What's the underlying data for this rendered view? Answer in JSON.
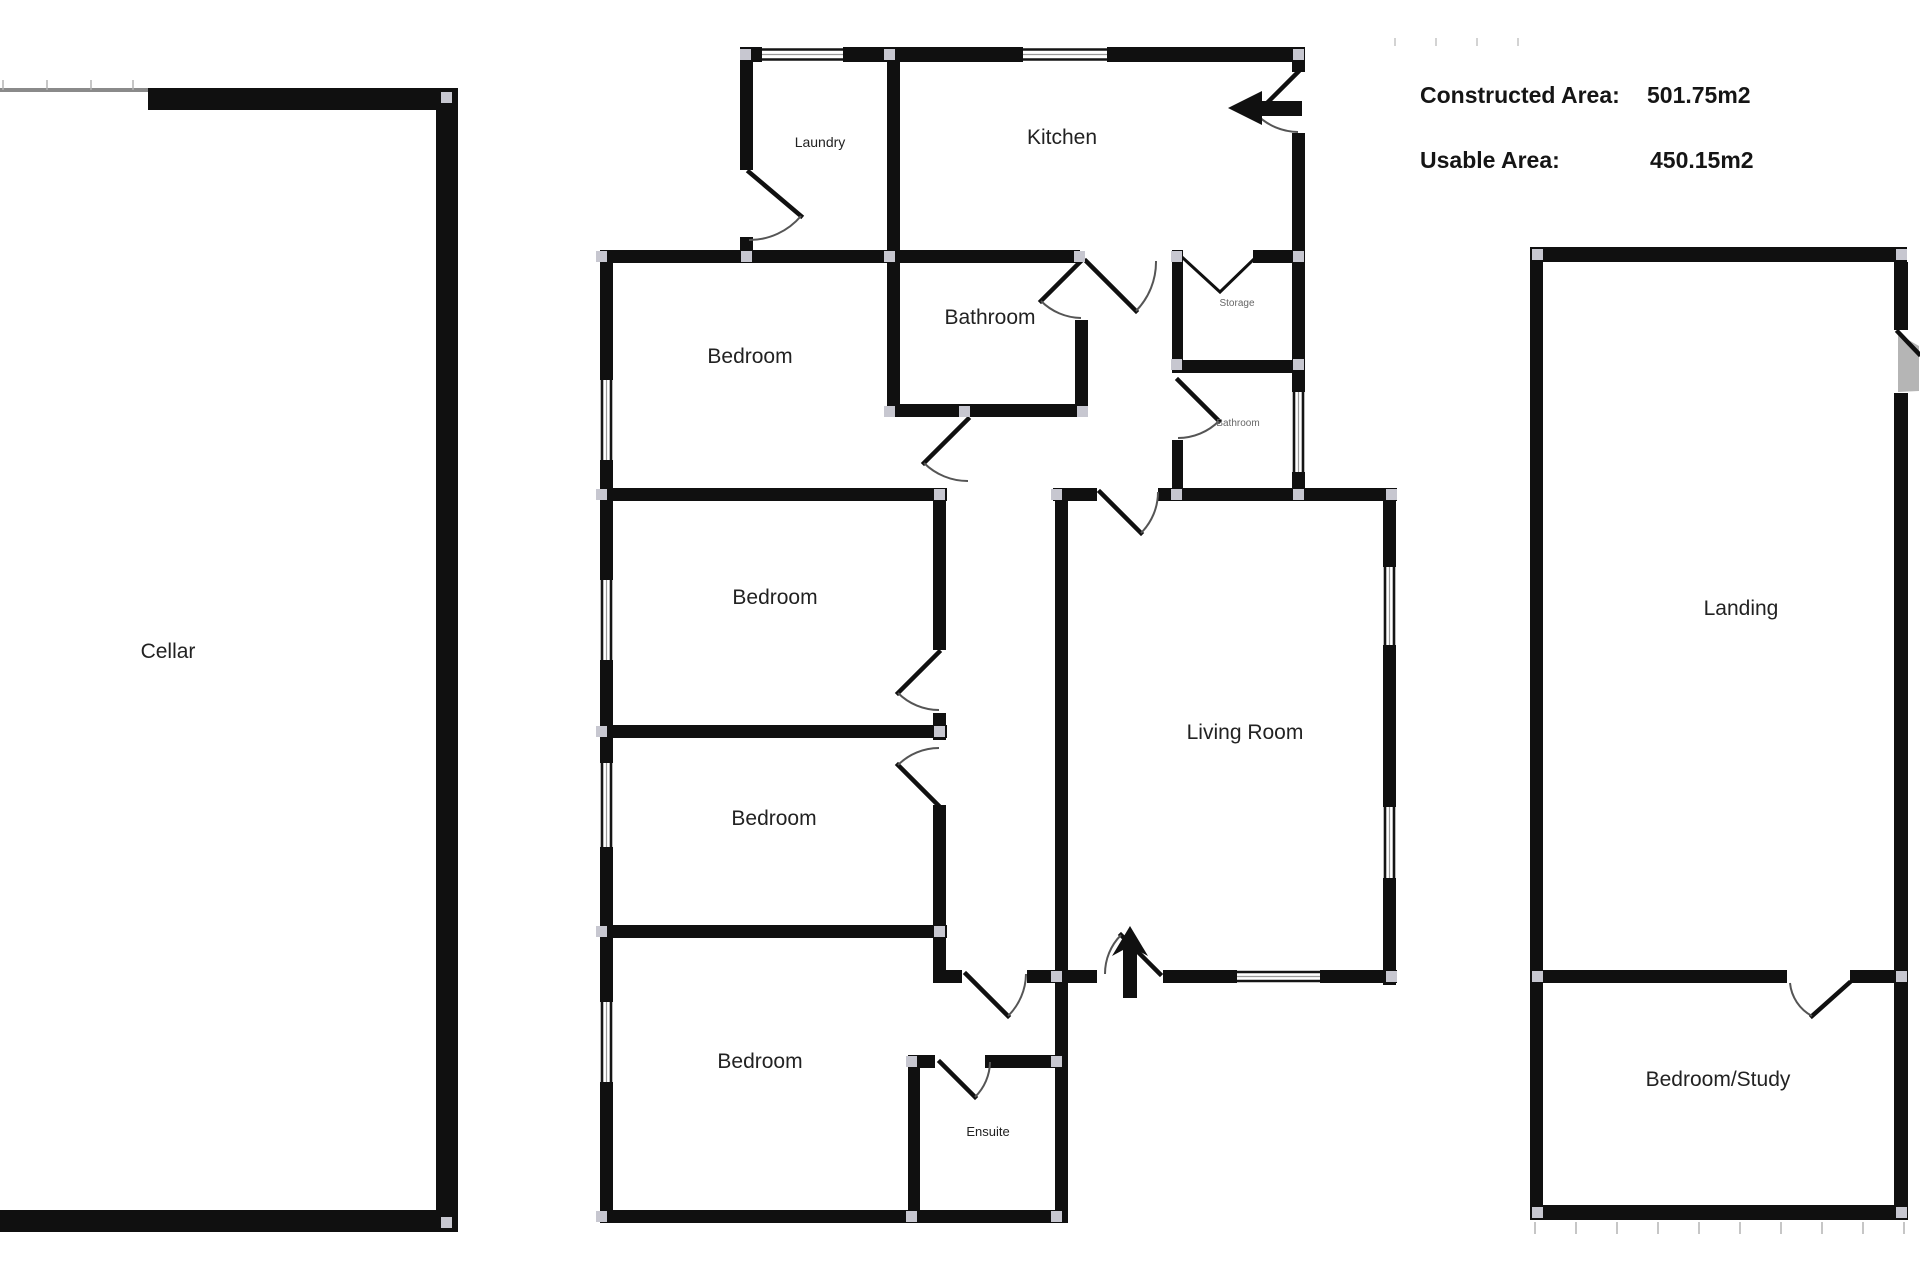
{
  "summary": {
    "constructed_label": "Constructed Area:",
    "constructed_value": "501.75m2",
    "usable_label": "Usable Area:",
    "usable_value": "450.15m2"
  },
  "rooms": {
    "cellar": "Cellar",
    "laundry": "Laundry",
    "kitchen": "Kitchen",
    "bathroom_main": "Bathroom",
    "storage": "Storage",
    "bathroom_small": "Bathroom",
    "bedroom_1": "Bedroom",
    "bedroom_2": "Bedroom",
    "bedroom_3": "Bedroom",
    "bedroom_4": "Bedroom",
    "living_room": "Living Room",
    "ensuite": "Ensuite",
    "landing": "Landing",
    "bedroom_study": "Bedroom/Study"
  },
  "colors": {
    "wall": "#101010",
    "corner_marker": "#c7c7d0",
    "door_arc": "#555555",
    "label": "#222222",
    "minor_label": "#666666"
  }
}
